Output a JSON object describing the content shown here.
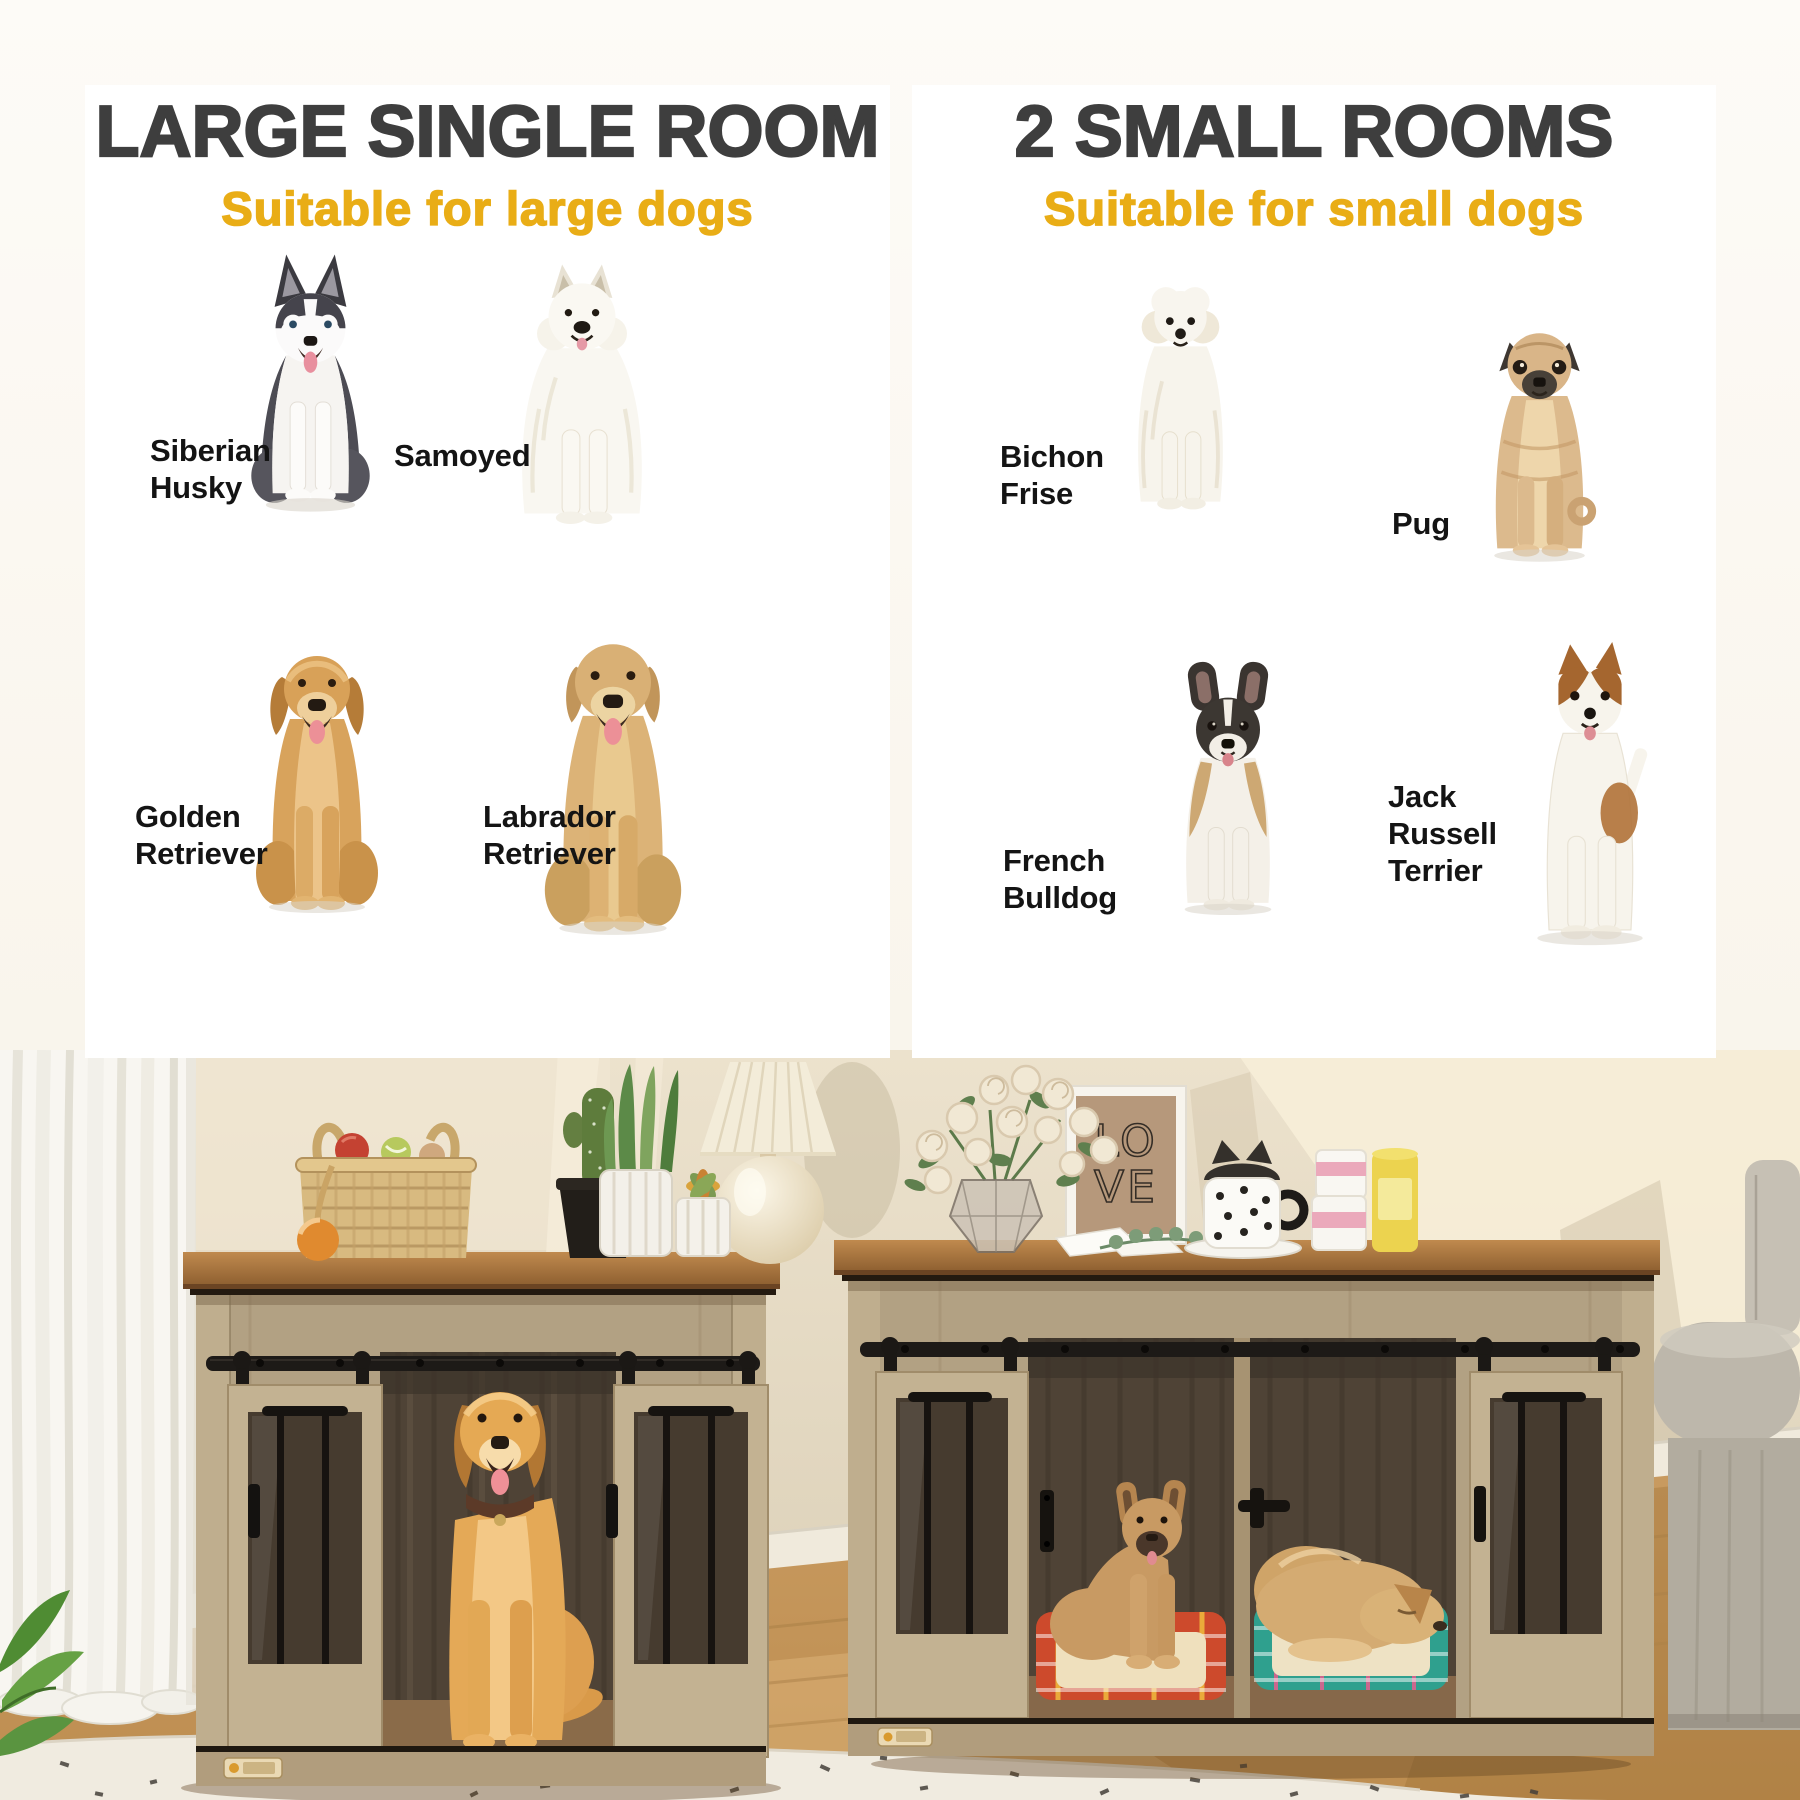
{
  "page": {
    "background": "#faf6ef"
  },
  "colors": {
    "title_gray": "#3e3e3e",
    "accent_yellow": "#e9ad16",
    "label_black": "#141414",
    "panel_white": "#ffffff",
    "crate_wood": "#b2a183",
    "crate_top_wood": "#a4713a",
    "metal_black": "#1d1a17"
  },
  "panels": {
    "left": {
      "title": "LARGE SINGLE ROOM",
      "subtitle": "Suitable for large dogs",
      "breeds": [
        "Siberian Husky",
        "Samoyed",
        "Golden Retriever",
        "Labrador Retriever"
      ]
    },
    "right": {
      "title": "2 SMALL ROOMS",
      "subtitle": "Suitable for small dogs",
      "breeds": [
        "Bichon Frise",
        "Pug",
        "French Bulldog",
        "Jack Russell Terrier"
      ]
    }
  },
  "scene": {
    "love_print_lines": [
      "LO",
      "VE"
    ]
  }
}
